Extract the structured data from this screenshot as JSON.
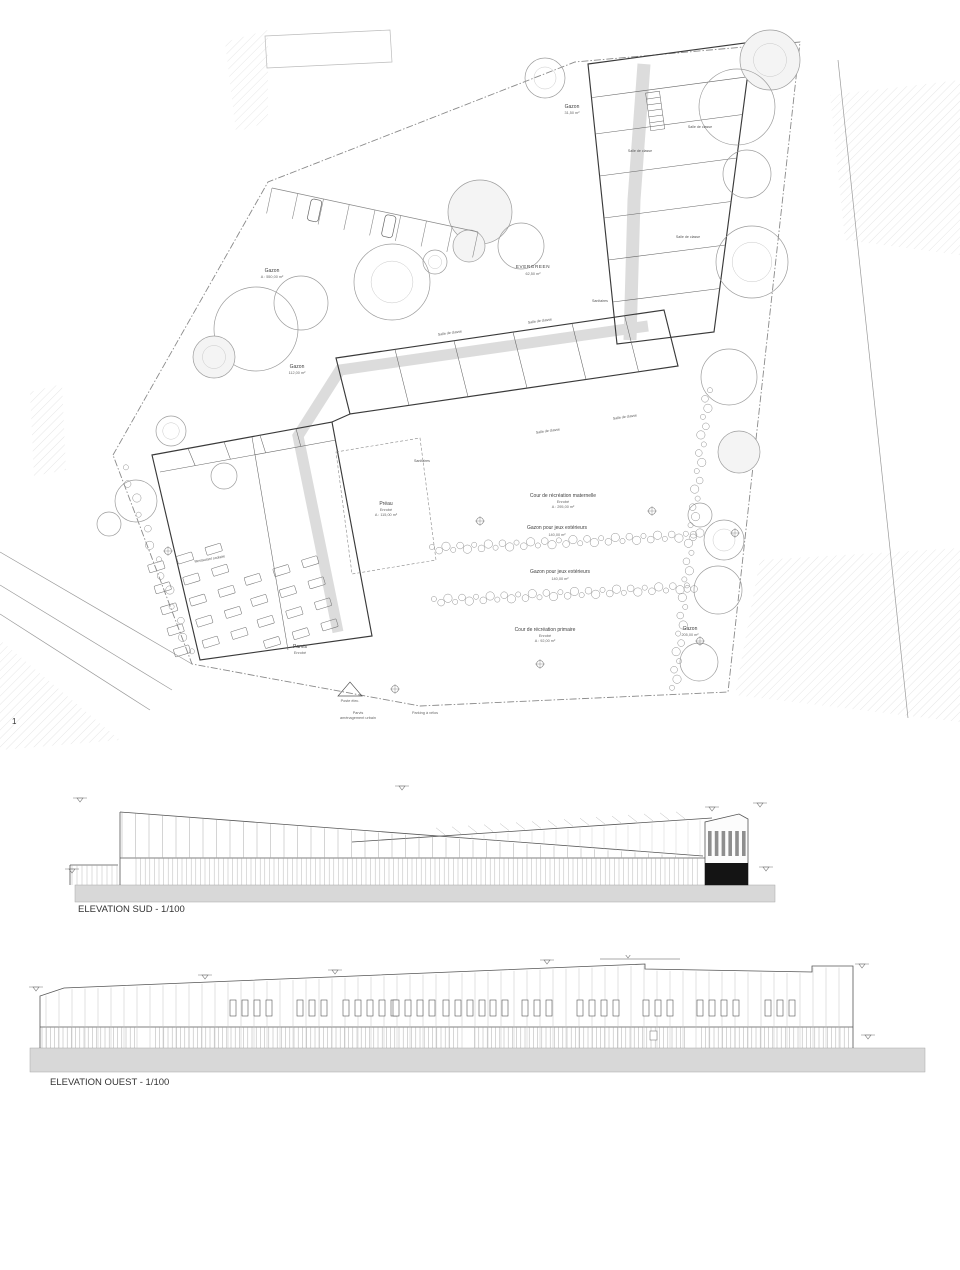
{
  "sheet": {
    "number": "1"
  },
  "site_plan": {
    "labels": {
      "gazon_nw": {
        "line1": "Gazon",
        "line2": "A : 550,00 m²"
      },
      "gazon_w": {
        "line1": "Gazon",
        "line2": "112,00 m²"
      },
      "gazon_ne": {
        "line1": "Gazon",
        "line2": "31,50 m²"
      },
      "evergreen": {
        "line1": "EVERGREEN",
        "line2": "62,50 m²"
      },
      "cour_maternelle": {
        "line1": "Cour de récréation maternelle",
        "line2": "Enrobé",
        "line3": "A : 295,00 m²"
      },
      "gazon_jeux_1": {
        "line1": "Gazon pour jeux extérieurs",
        "line2": "140,00 m²"
      },
      "gazon_jeux_2": {
        "line1": "Gazon pour jeux extérieurs",
        "line2": "140,00 m²"
      },
      "cour_primaire": {
        "line1": "Cour de récréation primaire",
        "line2": "Enrobé",
        "line3": "A : 92,00 m²"
      },
      "gazon_se": {
        "line1": "Gazon",
        "line2": "205,00 m²"
      },
      "preau": {
        "line1": "Préau",
        "line2": "Enrobé",
        "line3": "A : 115,00 m²"
      },
      "parvis": {
        "line1": "Parvis",
        "line2": "Enrobé"
      },
      "parvis_urbain": {
        "line1": "Parvis",
        "line2": "aménagement urbain"
      },
      "velos": {
        "line1": "Parking à vélos"
      },
      "poste_elec": {
        "line1": "Poste élec."
      }
    },
    "rooms": [
      {
        "label": "Salle de classe"
      },
      {
        "label": "Salle de classe"
      },
      {
        "label": "Salle de classe"
      },
      {
        "label": "Salle de classe"
      },
      {
        "label": "Salle de classe"
      },
      {
        "label": "Salle de classe"
      },
      {
        "label": "Salle de classe"
      },
      {
        "label": "Sanitaires"
      },
      {
        "label": "Sanitaires"
      },
      {
        "label": "Restaurant scolaire"
      }
    ]
  },
  "elevations": {
    "sud": {
      "title": "ELEVATION SUD - 1/100"
    },
    "ouest": {
      "title": "ELEVATION OUEST - 1/100"
    },
    "colors": {
      "ground_gray": "#d8d8d8",
      "black_base": "#141414",
      "window_bar": "#8e8e8e"
    }
  }
}
